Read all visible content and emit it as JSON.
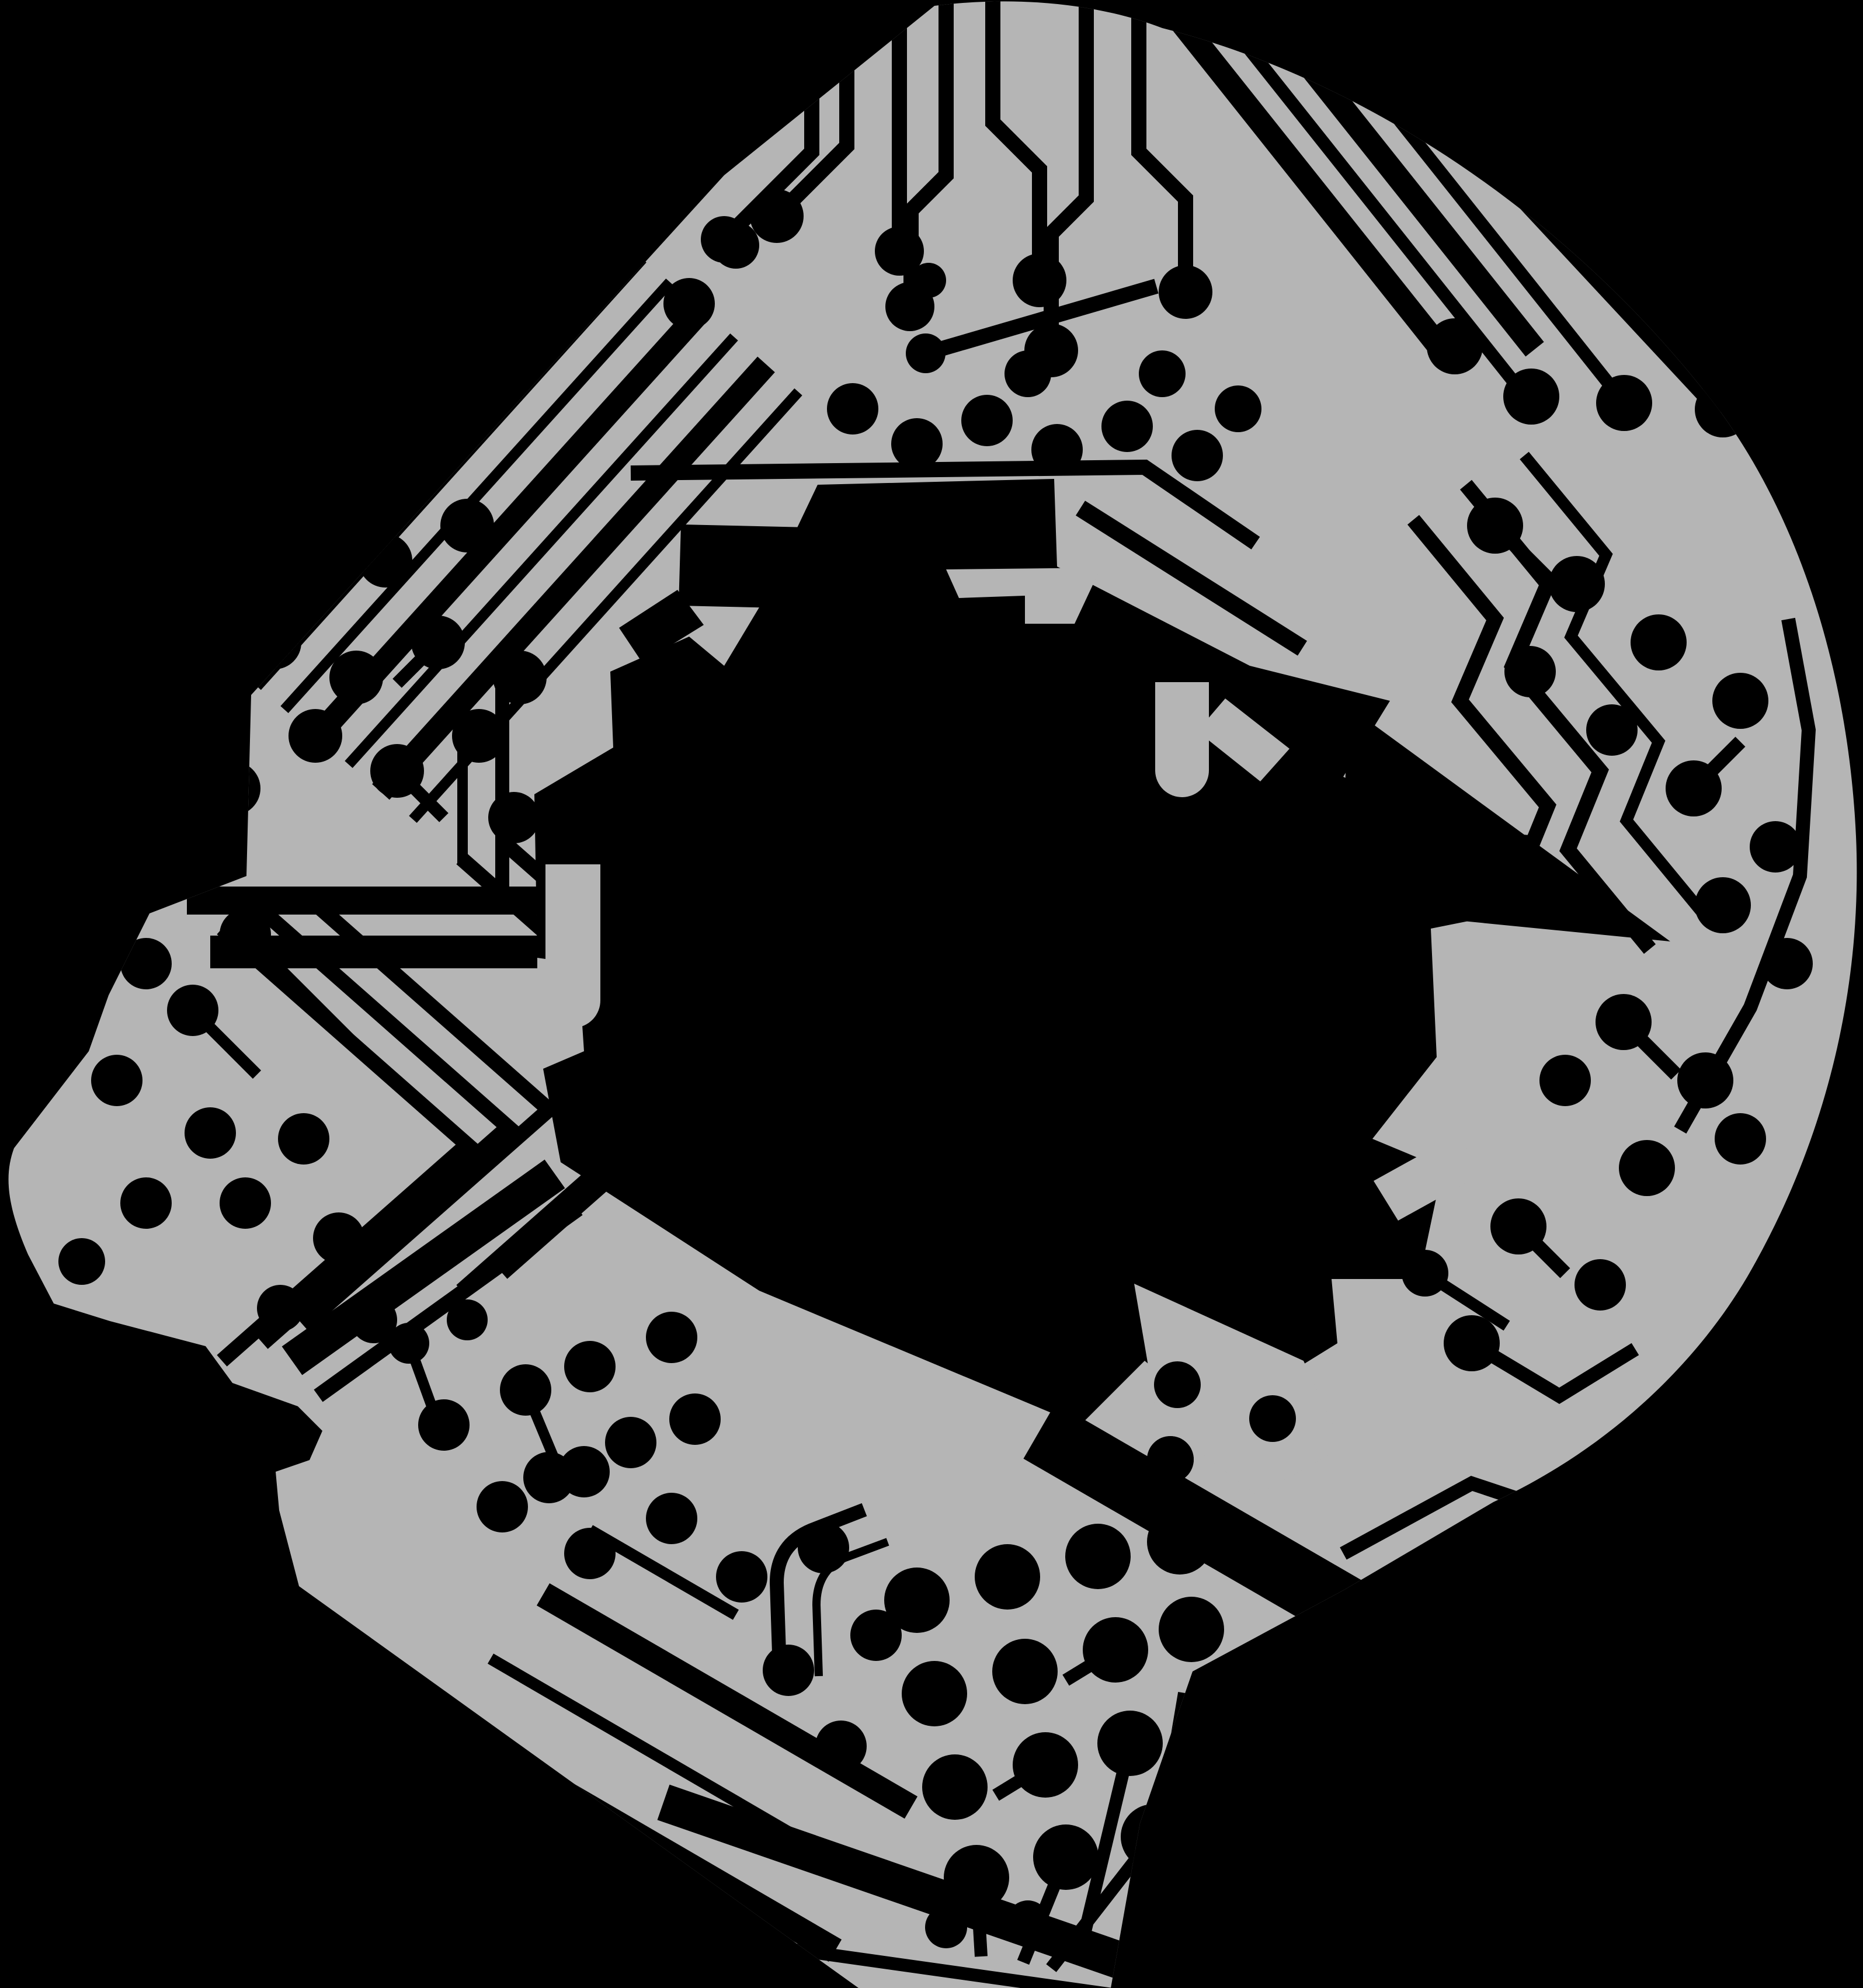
{
  "page": {
    "title": "Circuit Head Illustration"
  },
  "illustration": {
    "name": "circuit-head",
    "description": "Black-and-grey illustration of a human head in left-facing profile rendered as a printed circuit board: a grey board silhouette textured with black copper traces, solder pads and vias, a large irregular black cut-out region at its centre, on a solid black background.",
    "style": "printed-circuit-board silhouette",
    "facing": "left",
    "palette": {
      "background": "#000000",
      "board": "#b5b5b5",
      "trace": "#000000",
      "pad": "#000000"
    }
  }
}
